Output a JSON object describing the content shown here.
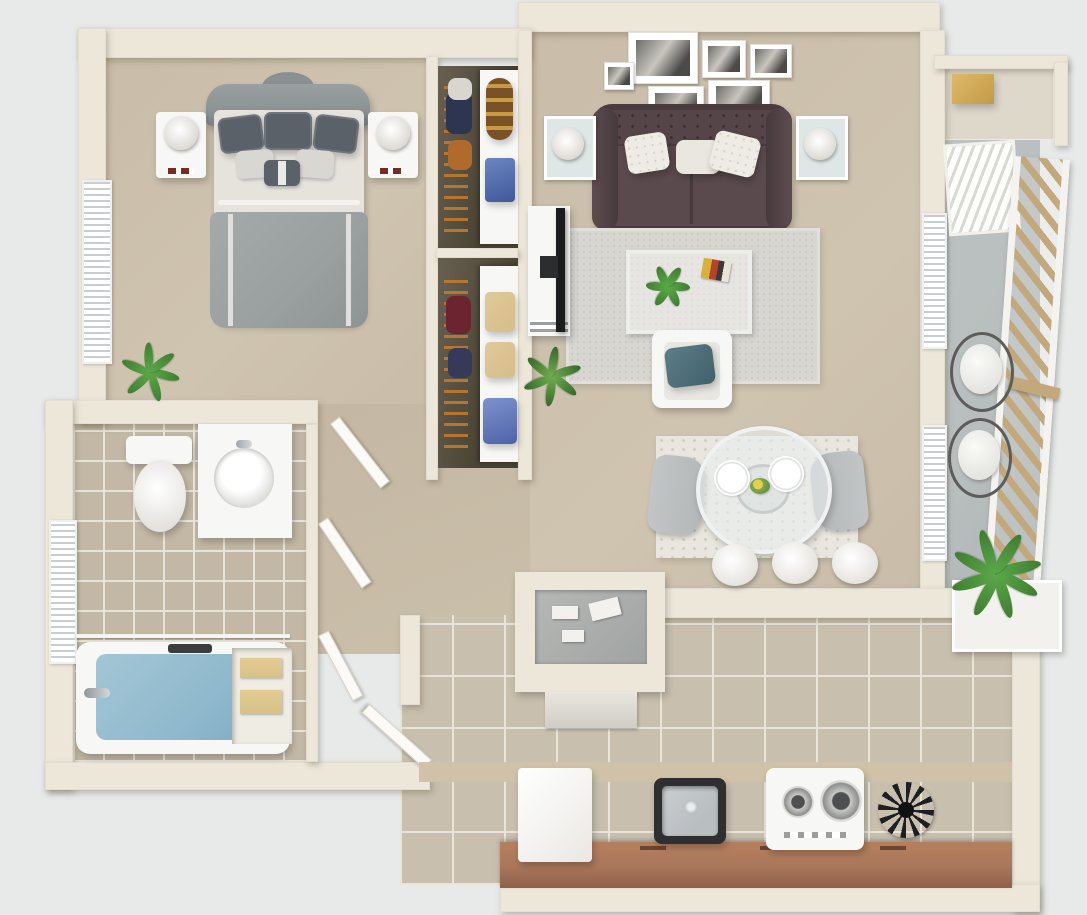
{
  "meta": {
    "description": "3D rendered top-down floor plan of a one-bedroom apartment",
    "view": "top-down 3D dollhouse render",
    "visible_text": "none"
  },
  "palette": {
    "background": "#e8eaea",
    "wall": "#ece7d9",
    "carpet": "#c9bda9",
    "kitchen_tile": "#c8bfae",
    "bath_tile": "#c2b8a5",
    "sofa": "#4a3b3e",
    "bed_duvet": "#9aa0a0",
    "water": "#8fb9cc",
    "wood_railing": "#c3a87c",
    "counter": "#a9765a",
    "plant": "#4f9e3f",
    "denim": "#5b79b8",
    "towels": "#d8c187"
  },
  "rooms": {
    "bedroom": {
      "name": "bedroom",
      "items": [
        "upholstered-bed",
        "gray-duvet",
        "pillows",
        "nightstand-left",
        "nightstand-right",
        "table-lamp-left",
        "table-lamp-right",
        "window-blinds",
        "potted-plant"
      ]
    },
    "closets": {
      "name": "walk-in-closets",
      "items": [
        "hanging-clothes",
        "duffel-bag",
        "folded-jeans",
        "storage-boxes",
        "folded-shirt",
        "shelving"
      ]
    },
    "living_room": {
      "name": "living-room",
      "items": [
        "tufted-sofa",
        "throw-pillows",
        "gallery-wall-6-frames",
        "side-table-lamp-left",
        "side-table-lamp-right",
        "area-rug",
        "glass-coffee-table",
        "coffee-table-plant",
        "magazine",
        "tv-console",
        "flatscreen-tv",
        "accent-armchair",
        "armchair-pillow",
        "snake-plant"
      ]
    },
    "dining_area": {
      "name": "dining-area",
      "items": [
        "round-glass-table",
        "dining-chair-left",
        "dining-chair-right",
        "place-settings",
        "centerpiece",
        "distressed-rug",
        "bar-stools-x3",
        "window-blinds"
      ]
    },
    "balcony": {
      "name": "balcony",
      "items": [
        "storage-closet",
        "storage-box",
        "louvered-door",
        "wood-slat-railing",
        "wire-chair-x2",
        "planter-plant",
        "large-plant"
      ]
    },
    "bathroom": {
      "name": "bathroom",
      "items": [
        "toilet",
        "vanity-sink",
        "faucet",
        "bathtub",
        "shower-rod",
        "window-blinds",
        "linen-shelf-towels",
        "tile-floor"
      ]
    },
    "hallway": {
      "name": "hallway",
      "items": [
        "open-doors",
        "carpet"
      ]
    },
    "kitchen": {
      "name": "kitchen",
      "items": [
        "refrigerator",
        "kitchen-sink",
        "range-stove",
        "dish-rack",
        "base-cabinets",
        "backsplash",
        "peninsula-counter",
        "small-appliances",
        "dishwasher",
        "breakfast-bar",
        "entry-door",
        "tile-floor"
      ]
    }
  }
}
